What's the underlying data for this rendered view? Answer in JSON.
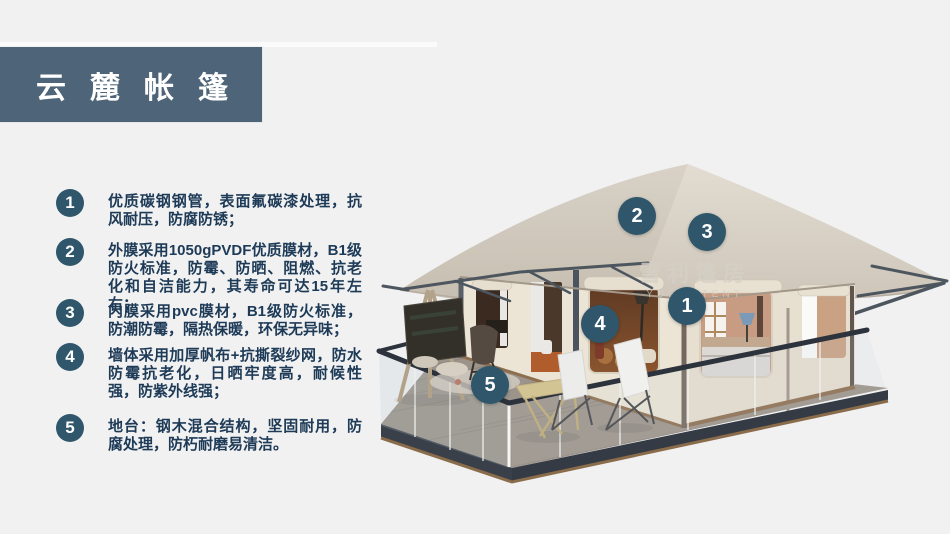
{
  "header": {
    "title": "云麓帐篷"
  },
  "features": [
    {
      "num": "1",
      "text": "优质碳钢钢管，表面氟碳漆处理，抗风耐压，防腐防锈；"
    },
    {
      "num": "2",
      "text": "外膜采用1050gPVDF优质膜材，B1级防火标准，防霉、防晒、阻燃、抗老化和自洁能力，其寿命可达15年左右；"
    },
    {
      "num": "3",
      "text": "内膜采用pvc膜材，B1级防火标准，防潮防霉，隔热保暖，环保无异味；"
    },
    {
      "num": "4",
      "text": "墙体采用加厚帆布+抗撕裂纱网，防水防霉抗老化，日晒牢度高，耐候性强，防紫外线强；"
    },
    {
      "num": "5",
      "text": "地台：钢木混合结构，坚固耐用，防腐处理，防朽耐磨易清洁。"
    }
  ],
  "illustration": {
    "subject": "safari-glamping-tent-3d-render",
    "watermark": {
      "cn": "雪利篷房",
      "en": "YUELI TENT"
    },
    "callouts": [
      {
        "num": "1"
      },
      {
        "num": "2"
      },
      {
        "num": "3"
      },
      {
        "num": "4"
      },
      {
        "num": "5"
      }
    ]
  },
  "colors": {
    "background": "#f1f1f2",
    "banner": "#4e6478",
    "badge_accent": "#2f566b",
    "body_text": "#1d3a56",
    "roof_canvas": "#d6cfc3",
    "wall_canvas": "#ebe4d5",
    "deck_wood": "#9c948b",
    "frame_steel": "#4d565f"
  }
}
